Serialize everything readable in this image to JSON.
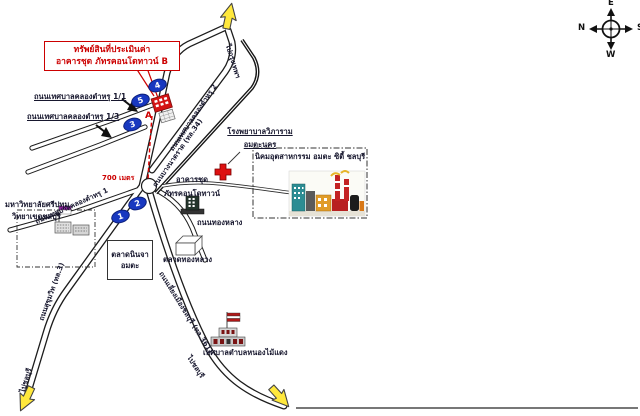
{
  "map": {
    "property_box": {
      "line1": "ทรัพย์สินที่ประเมินค่า",
      "line2": "อาคารชุด ภัทรคอนโดทาวน์ B"
    },
    "compass": {
      "top": "E",
      "left": "N",
      "right": "S",
      "bottom": "W"
    },
    "roads": {
      "soi_1_1": "ถนนเทศบาลคลองตำหรุ 1/1",
      "soi_1_3": "ถนนเทศบาลคลองตำหรุ 1/3",
      "soi_1": "ถนนเทศบาลคลองตำหรุ 1",
      "soi_2": "ถนนเทศบาลคลองตำหรุ 2",
      "bangna_trat": "ถนนบางนาตราด (ทล.34)",
      "sukhumvit": "ถนนสุขุมวิท (ทล.3)",
      "bypass": "ถนนเลี่ยงเมืองชลบุรี (ทล.361)",
      "thonglang": "ถนนทองหลาง"
    },
    "destinations": {
      "top": "ไปกรุงเทพฯ",
      "bottom_left": "ไปชลบุรี",
      "bottom_center": "ไปชลบุรี"
    },
    "markers": {
      "m1": "1",
      "m2": "2",
      "m3": "3",
      "m4": "4",
      "m5": "5",
      "property": "A"
    },
    "distance_label": "700 เมตร",
    "places": {
      "condo": {
        "line1": "อาคารชุด",
        "line2": "ภัทรคอนโดทาวน์"
      },
      "hospital": {
        "line1": "โรงพยาบาลวิภาราม",
        "line2": "อมตะนคร"
      },
      "industrial_estate": {
        "title": "นิคมอุตสาหกรรม อมตะ ซิตี้ ชลบุรี"
      },
      "university": {
        "line1": "มหาวิทยาลัยศรีปทุม",
        "line2": "วิทยาเขตชลบุรี"
      },
      "ninja_market": {
        "line1": "ตลาดนินจา",
        "line2": "อมตะ"
      },
      "thonglang_market": "ตลาดทองหลาง",
      "municipality": "เทศบาลตำบลหนองไม้แดง"
    },
    "colors": {
      "accent_red": "#cc0000",
      "marker_blue": "#1838c0",
      "arrow_yellow": "#ffe83c"
    }
  }
}
